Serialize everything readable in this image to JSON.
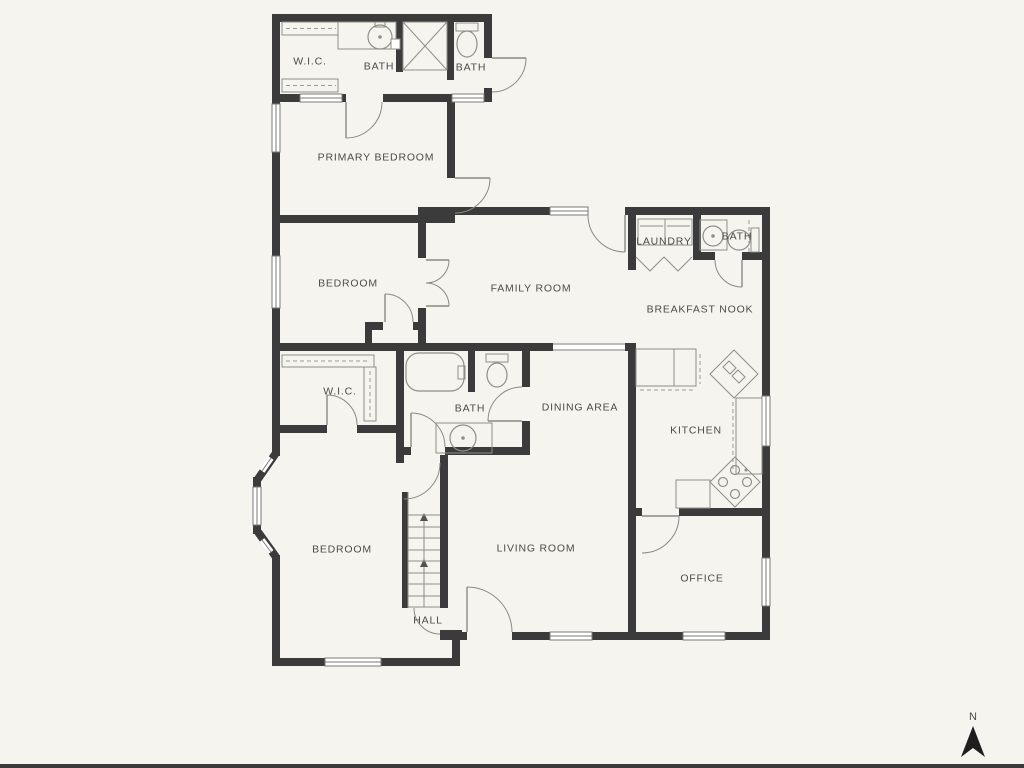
{
  "colors": {
    "background": "#F5F4EF",
    "wall": "#3B3B3B",
    "door_line": "#8A8A84",
    "window_line": "#7A7A75",
    "fixture_line": "#8F8F89",
    "dash_line": "#9A9A94",
    "label": "#4B4B49",
    "compass_arrow": "#1E1E1E"
  },
  "rooms": [
    {
      "id": "wic-top",
      "label": "W.I.C."
    },
    {
      "id": "bath-top",
      "label": "BATH"
    },
    {
      "id": "bath-top-right",
      "label": "BATH"
    },
    {
      "id": "primary-bedroom",
      "label": "PRIMARY BEDROOM"
    },
    {
      "id": "bedroom-middle",
      "label": "BEDROOM"
    },
    {
      "id": "family-room",
      "label": "FAMILY ROOM"
    },
    {
      "id": "laundry",
      "label": "LAUNDRY"
    },
    {
      "id": "bath-upper-right",
      "label": "BATH"
    },
    {
      "id": "breakfast-nook",
      "label": "BREAKFAST NOOK"
    },
    {
      "id": "wic-middle",
      "label": "W.I.C."
    },
    {
      "id": "bath-middle",
      "label": "BATH"
    },
    {
      "id": "dining-area",
      "label": "DINING AREA"
    },
    {
      "id": "kitchen",
      "label": "KITCHEN"
    },
    {
      "id": "bedroom-bottom",
      "label": "BEDROOM"
    },
    {
      "id": "living-room",
      "label": "LIVING ROOM"
    },
    {
      "id": "office",
      "label": "OFFICE"
    },
    {
      "id": "hall",
      "label": "HALL"
    }
  ],
  "compass": {
    "label": "N"
  }
}
